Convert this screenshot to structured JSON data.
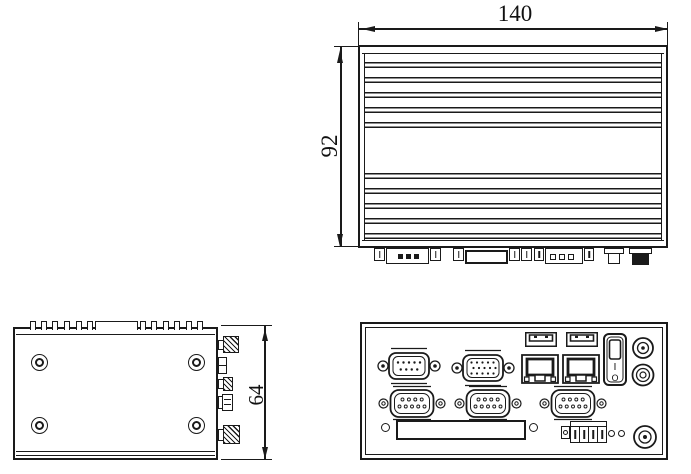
{
  "colors": {
    "line": "#1a1a1a",
    "background": "#ffffff"
  },
  "dimensions": {
    "width": "140",
    "depth": "92",
    "height": "64"
  },
  "views": {
    "top": {
      "connector_footprints": [
        "dsub-standoff",
        "db9-footprint",
        "vga-footprint",
        "dsub-standoff",
        "db-footprint",
        "dc-plug-footprint",
        "antenna-footprint"
      ]
    },
    "side": {
      "mount_holes": 4,
      "edge_connectors": [
        "antenna-connector",
        "stacked-port",
        "antenna-connector",
        "barrel-connector",
        "antenna-connector"
      ]
    },
    "front": {
      "power_switch": {
        "on_mark": "I",
        "off_mark": "O"
      },
      "connectors": [
        "db9-serial-male",
        "vga-port",
        "usb-port-1",
        "usb-port-2",
        "ethernet-port-1",
        "ethernet-port-2",
        "power-switch",
        "antenna-connector-top",
        "dc-jack",
        "serial-port-1",
        "serial-port-2",
        "serial-port-3",
        "expansion-slot",
        "power-terminal-block",
        "antenna-connector-bottom"
      ]
    }
  }
}
